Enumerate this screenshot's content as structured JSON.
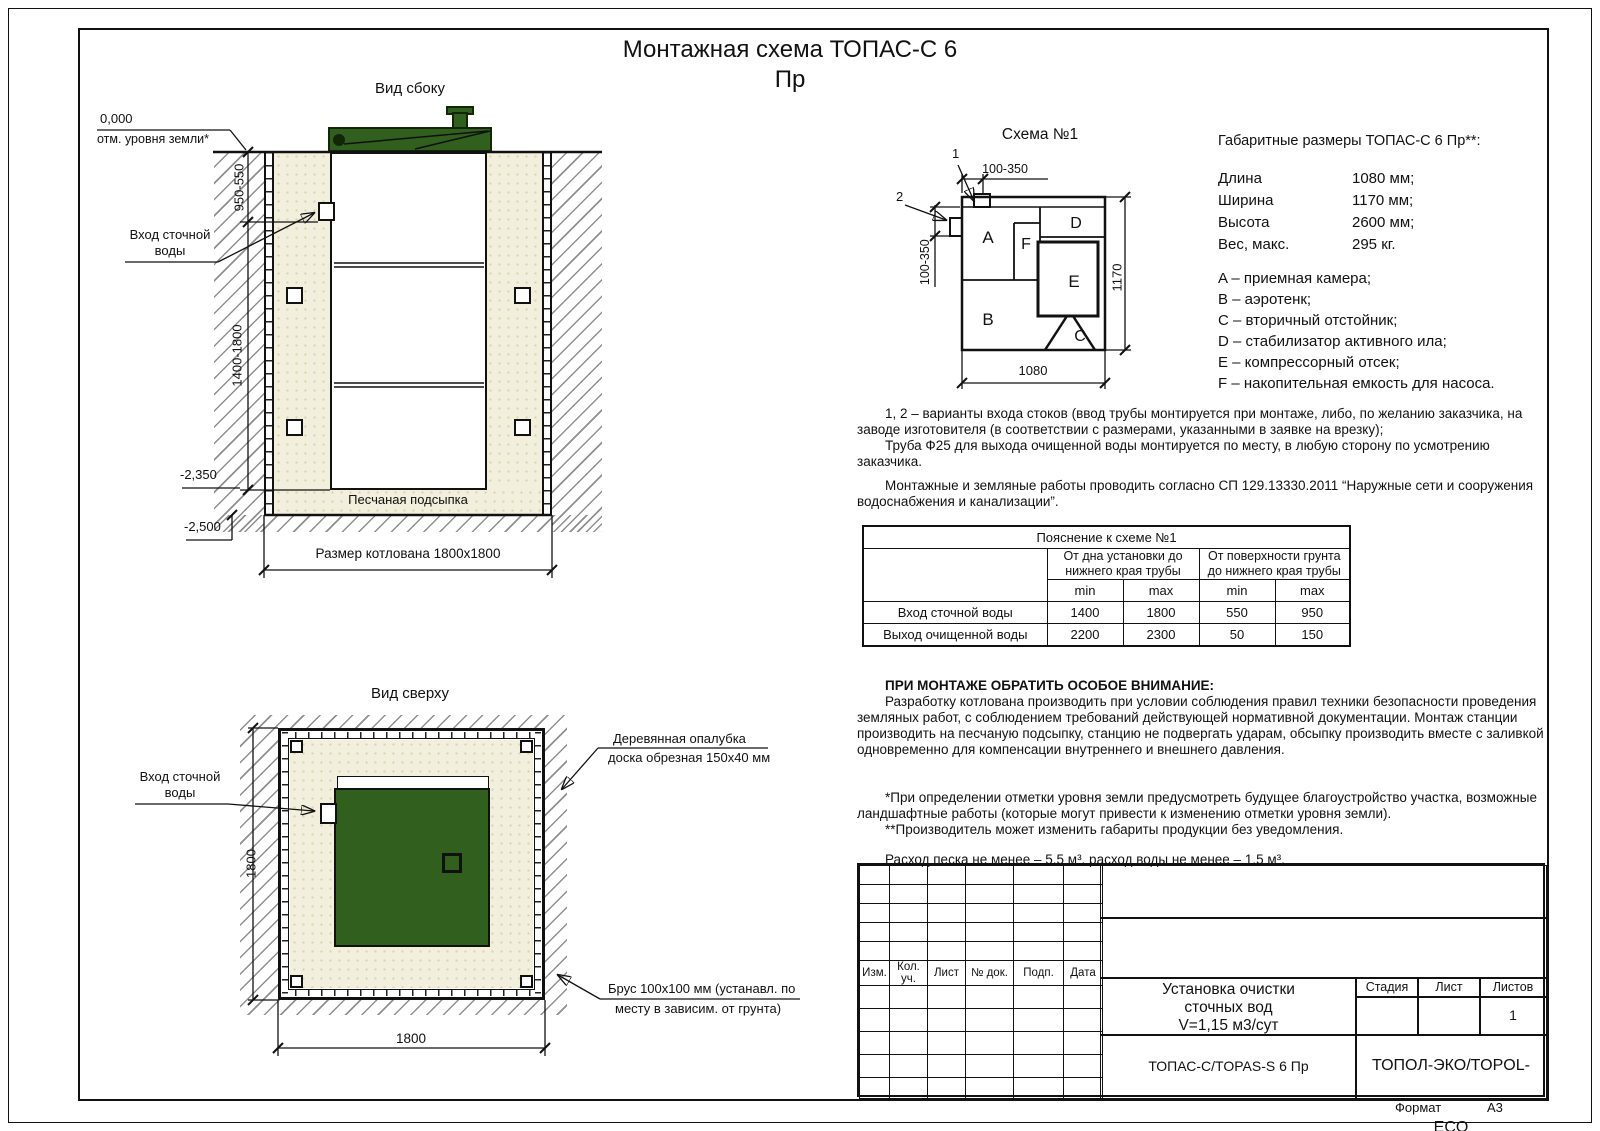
{
  "page": {
    "title_line1": "Монтажная схема ТОПАС-С 6",
    "title_line2": "Пр",
    "format_label": "Формат",
    "format_value": "А3"
  },
  "side_view": {
    "title": "Вид сбоку",
    "zero_mark": "0,000",
    "zero_label": "отм. уровня земли*",
    "dim_depth_top": "950-550",
    "dim_depth_main": "1400-1800",
    "inlet_line1": "Вход сточной",
    "inlet_line2": "воды",
    "mark_minus_2350": "-2,350",
    "mark_minus_2500": "-2,500",
    "sand_label": "Песчаная подсыпка",
    "pit_label": "Размер котлована 1800х1800"
  },
  "top_view": {
    "title": "Вид сверху",
    "inlet_line1": "Вход сточной",
    "inlet_line2": "воды",
    "dim_vertical": "1800",
    "dim_horizontal": "1800",
    "formwork_line1": "Деревянная опалубка",
    "formwork_line2": "доска обрезная 150х40 мм",
    "beam_line1": "Брус 100х100 мм (устанавл. по",
    "beam_line2": "месту в зависим. от грунта)"
  },
  "schema": {
    "title": "Схема №1",
    "marker1": "1",
    "marker2": "2",
    "dim_top": "100-350",
    "dim_left": "100-350",
    "dim_bottom": "1080",
    "dim_right": "1170",
    "labels": {
      "A": "A",
      "B": "B",
      "C": "C",
      "D": "D",
      "E": "E",
      "F": "F"
    }
  },
  "specs": {
    "title": "Габаритные размеры ТОПАС-С 6 Пр**:",
    "rows": [
      {
        "label": "Длина",
        "value": "1080 мм;"
      },
      {
        "label": "Ширина",
        "value": "1170 мм;"
      },
      {
        "label": "Высота",
        "value": "2600 мм;"
      },
      {
        "label": "Вес, макс.",
        "value": "295 кг."
      }
    ],
    "legend": [
      "A – приемная камера;",
      "B – аэротенк;",
      "C – вторичный отстойник;",
      "D – стабилизатор активного ила;",
      "E – компрессорный отсек;",
      "F – накопительная емкость для насоса."
    ]
  },
  "notes": {
    "n1p1": "1, 2 – варианты входа  стоков (ввод трубы монтируется при монтаже, либо, по желанию заказчика, на заводе изготовителя (в соответствии с размерами, указанными в заявке на врезку);",
    "n1p2": "Труба Ф25 для выхода очищенной воды монтируется по месту, в любую сторону по усмотрению заказчика.",
    "n2": "Монтажные и земляные работы проводить согласно СП 129.13330.2011 “Наружные сети и сооружения водоснабжения и канализации”.",
    "attention_title": "ПРИ МОНТАЖЕ ОБРАТИТЬ ОСОБОЕ ВНИМАНИЕ:",
    "attention_body": "Разработку котлована производить при условии соблюдения правил техники безопасности проведения земляных работ, с соблюдением требований действующей нормативной документации. Монтаж станции производить на песчаную подсыпку, станцию не подвергать ударам, обсыпку производить вместе с заливкой одновременно для компенсации внутреннего и внешнего давления.",
    "footnote1": "*При определении отметки уровня земли предусмотреть будущее благоустройство участка, возможные ландшафтные работы (которые могут привести к изменению отметки уровня земли).",
    "footnote2": "**Производитель может изменить габариты продукции без уведомления.",
    "consumption": "Расход песка не менее – 5,5 м³, расход воды не менее – 1,5 м³."
  },
  "table": {
    "title": "Пояснение к схеме №1",
    "group1_line1": "От дна установки до",
    "group1_line2": "нижнего края трубы",
    "group2_line1": "От поверхности грунта",
    "group2_line2": "до нижнего края трубы",
    "min": "min",
    "max": "max",
    "rows": [
      {
        "label": "Вход сточной воды",
        "v": [
          "1400",
          "1800",
          "550",
          "950"
        ]
      },
      {
        "label": "Выход очищенной воды",
        "v": [
          "2200",
          "2300",
          "50",
          "150"
        ]
      }
    ]
  },
  "title_block": {
    "rev_headers": [
      "Изм.",
      "Кол. уч.",
      "Лист",
      "№ док.",
      "Подп.",
      "Дата"
    ],
    "doc_line1": "Установка очистки",
    "doc_line2": "сточных вод",
    "doc_line3": "V=1,15 м3/сут",
    "stage_label": "Стадия",
    "sheet_label": "Лист",
    "sheets_label": "Листов",
    "sheets_value": "1",
    "model": "ТОПАС-С/TOPAS-S 6 Пр",
    "company": "ТОПОЛ-ЭКО/TOPOL-ECO"
  },
  "colors": {
    "tank_green": "#305f1e",
    "sand": "#f2efdd",
    "line": "#111111"
  }
}
